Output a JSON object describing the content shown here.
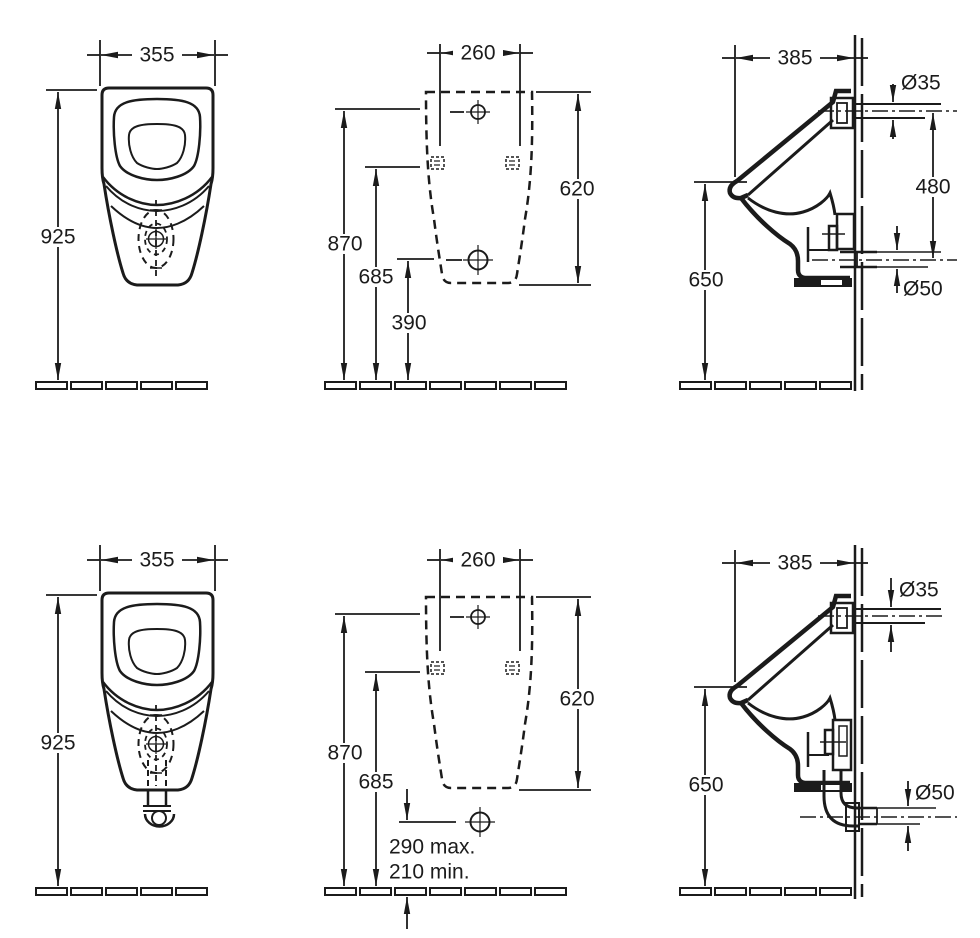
{
  "drawing": {
    "ink_color": "#1b1b1b",
    "background_color": "#ffffff",
    "rows": {
      "top": {
        "front": {
          "width": "355",
          "height": "925"
        },
        "back": {
          "spread": "260",
          "inlet_height": "870",
          "fixing_height": "685",
          "outlet_height": "390",
          "body_height": "620"
        },
        "side": {
          "depth": "385",
          "inlet_dia": "Ø35",
          "inlet_outlet_dist": "480",
          "outlet_dia": "Ø50",
          "lip_height": "650"
        }
      },
      "bottom": {
        "front": {
          "width": "355",
          "height": "925"
        },
        "back": {
          "spread": "260",
          "inlet_height": "870",
          "fixing_height": "685",
          "outlet_max": "290 max.",
          "outlet_min": "210 min.",
          "body_height": "620"
        },
        "side": {
          "depth": "385",
          "inlet_dia": "Ø35",
          "outlet_dia": "Ø50",
          "lip_height": "650"
        }
      }
    }
  }
}
